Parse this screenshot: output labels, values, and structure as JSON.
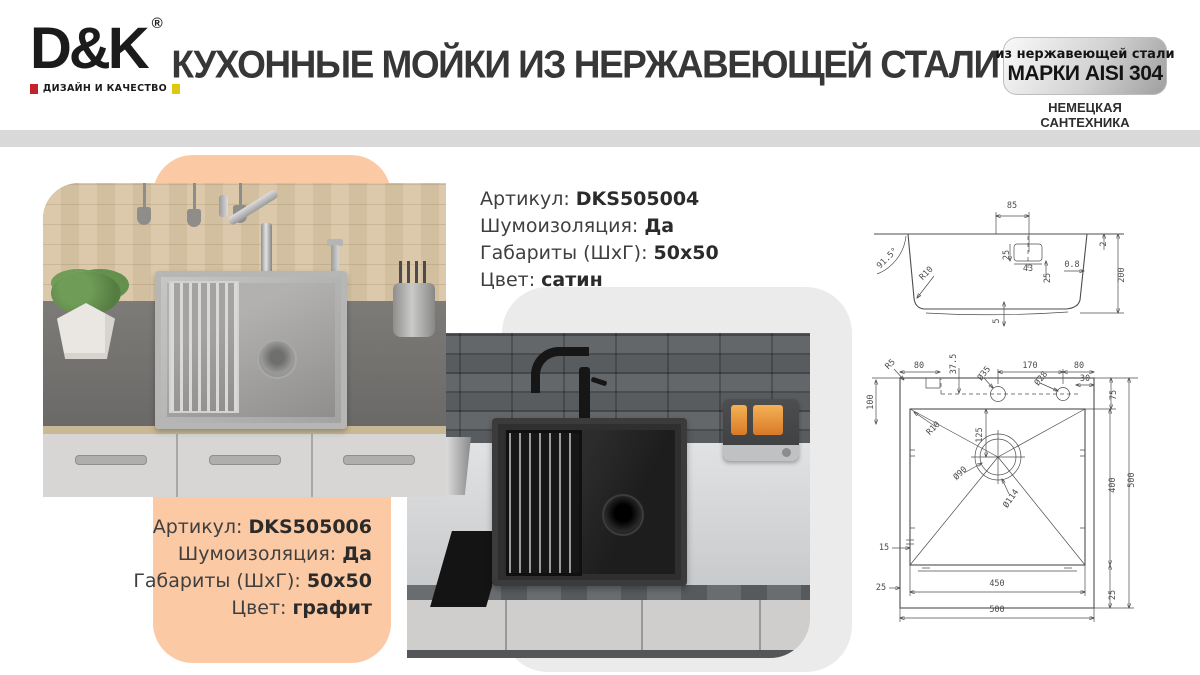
{
  "header": {
    "logo_text": "D&K",
    "logo_reg": "®",
    "logo_tagline": "ДИЗАЙН И КАЧЕСТВО",
    "title": "КУХОННЫЕ МОЙКИ ИЗ НЕРЖАВЕЮЩЕЙ СТАЛИ",
    "badge_line1": "из нержавеющей стали",
    "badge_line2": "МАРКИ AISI 304",
    "subtitle_line1": "НЕМЕЦКАЯ САНТЕХНИКА",
    "subtitle_line2": "ВЫСОКОГО КАЧЕСТВА"
  },
  "products": [
    {
      "rows": [
        {
          "label": "Артикул: ",
          "value": "DKS505004"
        },
        {
          "label": "Шумоизоляция: ",
          "value": "Да"
        },
        {
          "label": "Габариты (ШхГ): ",
          "value": "50х50"
        },
        {
          "label": "Цвет: ",
          "value": "сатин"
        }
      ]
    },
    {
      "rows": [
        {
          "label": "Артикул: ",
          "value": "DKS505006"
        },
        {
          "label": "Шумоизоляция: ",
          "value": "Да"
        },
        {
          "label": "Габариты (ШхГ): ",
          "value": "50х50"
        },
        {
          "label": "Цвет: ",
          "value": "графит"
        }
      ]
    }
  ],
  "colors": {
    "accent_peach": "#fbc9a4",
    "deco_gray": "#ebebeb",
    "divider_gray": "#d9d9d9",
    "logo_red": "#c4232b",
    "logo_yellow": "#dfc713",
    "drawing_line": "#4d4d4d"
  },
  "drawing": {
    "side_labels": [
      {
        "t": "85",
        "x": 156,
        "y": 36
      },
      {
        "t": "91.5°",
        "x": 33,
        "y": 88,
        "r": -45
      },
      {
        "t": "R10",
        "x": 72,
        "y": 103,
        "r": -45
      },
      {
        "t": "25",
        "x": 153,
        "y": 83,
        "r": -90
      },
      {
        "t": "43",
        "x": 172,
        "y": 99
      },
      {
        "t": "25",
        "x": 194,
        "y": 106,
        "r": -90
      },
      {
        "t": "0.8",
        "x": 216,
        "y": 95
      },
      {
        "t": "2",
        "x": 250,
        "y": 72,
        "r": -90
      },
      {
        "t": "200",
        "x": 268,
        "y": 103,
        "r": -90
      },
      {
        "t": "5",
        "x": 143,
        "y": 149,
        "r": -90
      }
    ],
    "plan_labels": [
      {
        "t": "R5",
        "x": 36,
        "y": 194,
        "r": -45
      },
      {
        "t": "80",
        "x": 63,
        "y": 196
      },
      {
        "t": "37.5",
        "x": 100,
        "y": 192,
        "r": -90
      },
      {
        "t": "Ø35",
        "x": 130,
        "y": 203,
        "r": -52
      },
      {
        "t": "170",
        "x": 174,
        "y": 196
      },
      {
        "t": "Ø28",
        "x": 187,
        "y": 208,
        "r": -52
      },
      {
        "t": "80",
        "x": 223,
        "y": 196
      },
      {
        "t": "30",
        "x": 229,
        "y": 209
      },
      {
        "t": "100",
        "x": 17,
        "y": 230,
        "r": -90
      },
      {
        "t": "75",
        "x": 260,
        "y": 223,
        "r": -90
      },
      {
        "t": "R10",
        "x": 79,
        "y": 258,
        "r": -45
      },
      {
        "t": "125",
        "x": 126,
        "y": 263,
        "r": -90
      },
      {
        "t": "Ø90",
        "x": 106,
        "y": 303,
        "r": -45
      },
      {
        "t": "Ø114",
        "x": 157,
        "y": 328,
        "r": -55
      },
      {
        "t": "400",
        "x": 259,
        "y": 313,
        "r": -90
      },
      {
        "t": "500",
        "x": 278,
        "y": 308,
        "r": -90
      },
      {
        "t": "15",
        "x": 28,
        "y": 378
      },
      {
        "t": "25",
        "x": 25,
        "y": 418
      },
      {
        "t": "450",
        "x": 141,
        "y": 414
      },
      {
        "t": "500",
        "x": 141,
        "y": 440
      },
      {
        "t": "25",
        "x": 259,
        "y": 423,
        "r": -90
      }
    ]
  }
}
